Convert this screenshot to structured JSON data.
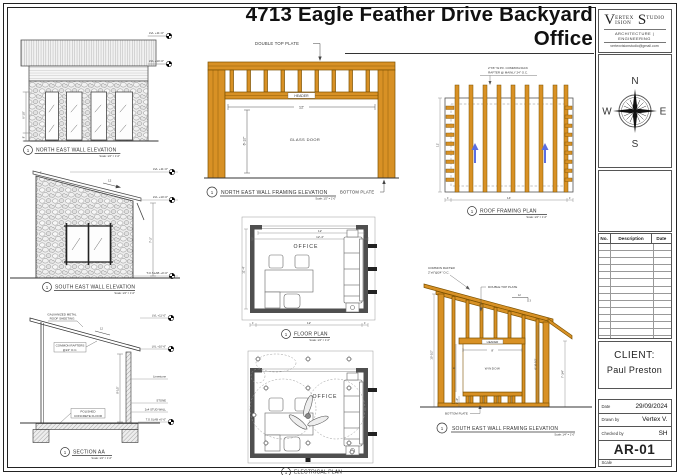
{
  "title": {
    "line1": "4713 Eagle Feather Drive Backyard",
    "line2": "Office"
  },
  "titleblock": {
    "logo": {
      "big1": "V",
      "part1": "ERTEX",
      "part2": "ISION",
      "big2": "S",
      "part3": "TUDIO",
      "subtitle": "ARCHITECTURE | ENGINEERING",
      "email": "vertexvisionstudio@gmail.com"
    },
    "compass": {
      "n": "N",
      "e": "E",
      "s": "S",
      "w": "W"
    },
    "revisions": {
      "col_no": "No.",
      "col_desc": "Description",
      "col_date": "Date"
    },
    "client": {
      "label": "CLIENT:",
      "name": "Paul Preston"
    },
    "info": {
      "date_label": "Date",
      "date": "29/09/2024",
      "drawn_label": "Drawn by",
      "drawn": "Vertex V.",
      "checked_label": "Checked by",
      "checked": "SH",
      "sheet": "AR-01",
      "scale_label": "Scale"
    }
  },
  "drawings": {
    "ne_elevation": {
      "number": "1",
      "title": "NORTH EAST WALL ELEVATION",
      "scale": "Scale: 1/4\" = 1'-0\"",
      "lvl_top": "LVL +11'-0\"",
      "lvl_low": "LVL +10'-0\"",
      "dim_left": "6'-10\"",
      "dim_left_small": "8\""
    },
    "se_elevation": {
      "number": "1",
      "title": "SOUTH EAST WALL ELEVATION",
      "scale": "Scale: 1/4\" = 1'-0\"",
      "lvl_top": "LVL +11'-0\"",
      "lvl_low": "LVL +10'-0\"",
      "slab": "T.O.SLAB +0'-0\"",
      "slope": "12",
      "dim_right": "7'-2\"",
      "dim_overhang": "1'"
    },
    "section_aa": {
      "number": "1",
      "title": "SECTION AA",
      "scale": "Scale: 1/4\" = 1'-0\"",
      "note_roof_1": "GALVANIZED METAL",
      "note_roof_2": "ROOF SHEETING",
      "note_rafter_1": "COMMON RAFTERS",
      "note_rafter_2": "@24\" O.C.",
      "note_floor_1": "POLISHED",
      "note_floor_2": "CONCRETE FLOOR",
      "lvl_top": "LVL +11'-0\"",
      "lvl_low": "LVL +10'-6\"",
      "lbl_limestone": "Limestone",
      "lbl_stone": "STONE",
      "lbl_stud": "2x4 STUD WALL",
      "slab": "T.O.SLAB +0'-0\"",
      "dim_height": "8'-1/2\"",
      "slope": "12"
    },
    "ne_framing": {
      "number": "1",
      "title": "NORTH EAST WALL FRAMING ELEVATION",
      "scale": "Scale: 1/2\" = 1'-0\"",
      "note_top_plate": "DOUBLE TOP PLATE",
      "header": "HEADER",
      "dim_width": "12'",
      "dim_height": "6'-10\"",
      "glass_door": "GLASS DOOR",
      "bottom_plate": "BOTTOM PLATE"
    },
    "floor_plan": {
      "number": "1",
      "title": "FLOOR PLAN",
      "scale": "Scale: 1/4\" = 1'-0\"",
      "room": "OFFICE",
      "dim_top_1": "12'",
      "dim_top_2": "12'-4\"",
      "dim_left": "11'-4\"",
      "dim_bottom": "12'",
      "dim_end": "1'"
    },
    "elec_plan": {
      "number": "1",
      "title": "ELECTRICAL PLAN",
      "room": "OFFICE"
    },
    "roof_framing": {
      "number": "1",
      "title": "ROOF FRAMING PLAN",
      "scale": "Scale: 1/4\" = 1'-0\"",
      "note_1": "2\"X6\" W.P.F. COMMON/JACK",
      "note_2": "RAFTER @ MAINLY 24\" O.C.",
      "dim_bottom": "14'",
      "dim_end": "1'",
      "dim_left": "12'"
    },
    "se_framing": {
      "number": "1",
      "title": "SOUTH EAST WALL FRAMING ELEVATION",
      "scale": "Scale: 1/4\" = 1'-0\"",
      "note_rafter_1": "COMMON RAFTER",
      "note_rafter_2": "2\"x6\"@24\" O.C.",
      "note_top_plate": "DOUBLE TOP PLATE",
      "header": "HEADER",
      "window": "WINDOW",
      "bottom_plate": "BOTTOM PLATE",
      "dim_window": "8'",
      "slope_rise": "3",
      "slope_run": "12",
      "dim_left": "10'-1/2\"",
      "dim_left_in": "6'",
      "dim_sill": "2'-10\"",
      "dim_right_in": "6'-10 1/2\"",
      "dim_right": "7'-3/4\""
    }
  }
}
